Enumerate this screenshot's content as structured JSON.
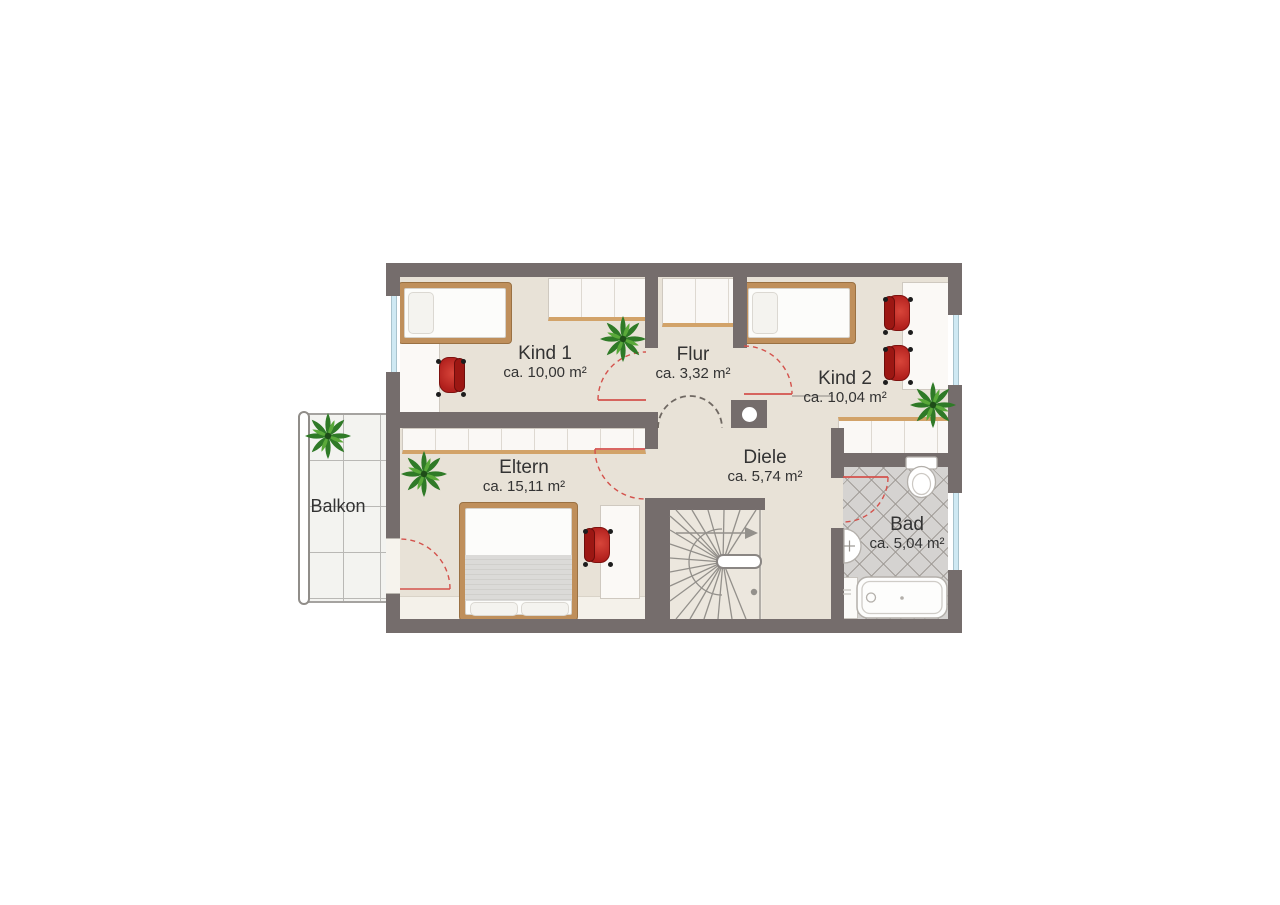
{
  "plan": {
    "rooms": [
      {
        "name": "Kind 1",
        "area": "ca. 10,00 m²"
      },
      {
        "name": "Flur",
        "area": "ca. 3,32 m²"
      },
      {
        "name": "Kind 2",
        "area": "ca. 10,04 m²"
      },
      {
        "name": "Eltern",
        "area": "ca. 15,11 m²"
      },
      {
        "name": "Diele",
        "area": "ca. 5,74 m²"
      },
      {
        "name": "Bad",
        "area": "ca. 5,04 m²"
      },
      {
        "name": "Balkon",
        "area": ""
      }
    ],
    "colors": {
      "wall": "#756d6c",
      "floor": "#e8e2d7",
      "floor_light": "#f4f1ea",
      "furniture_white": "#faf8f5",
      "wood": "#d2a369",
      "chair_red": "#b92420",
      "bath_tile": "#d5d3d1",
      "window_glass": "#cfe9f3",
      "door_swing_red": "#d4524c",
      "stair_line": "#93908b",
      "plant_green": "#45962f"
    }
  }
}
